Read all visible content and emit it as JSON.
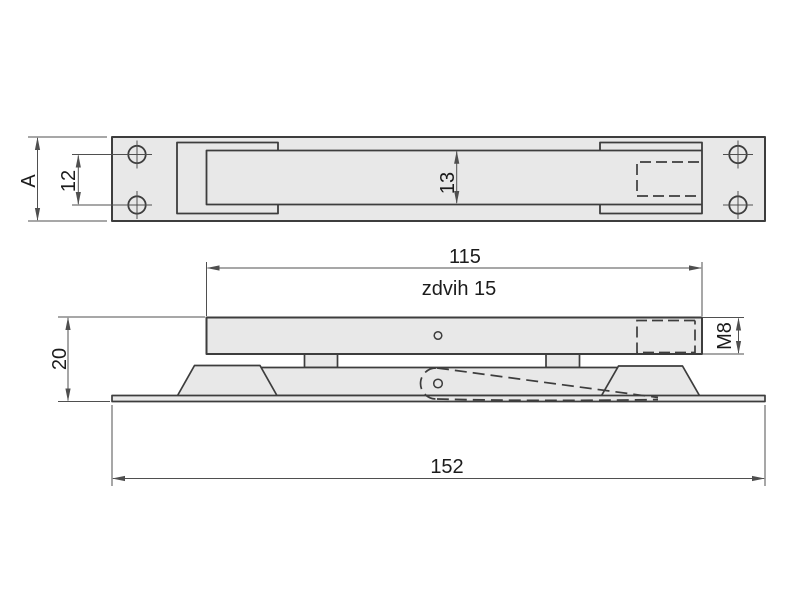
{
  "drawing": {
    "kind": "technical-drawing",
    "colors": {
      "part_fill": "#e8e8e8",
      "outline": "#3d3d3d",
      "dimension_lines": "#4f4f4f",
      "text": "#1c1c1c",
      "background": "#ffffff"
    },
    "top_view": {
      "dim_plate_width": "A",
      "dim_hole_spacing": "12",
      "dim_slider_width": "13"
    },
    "side_view": {
      "dim_slider_length": "115",
      "stroke_label": "zdvih 15",
      "dim_thread": "M8",
      "dim_height": "20",
      "dim_base_length": "152"
    }
  }
}
